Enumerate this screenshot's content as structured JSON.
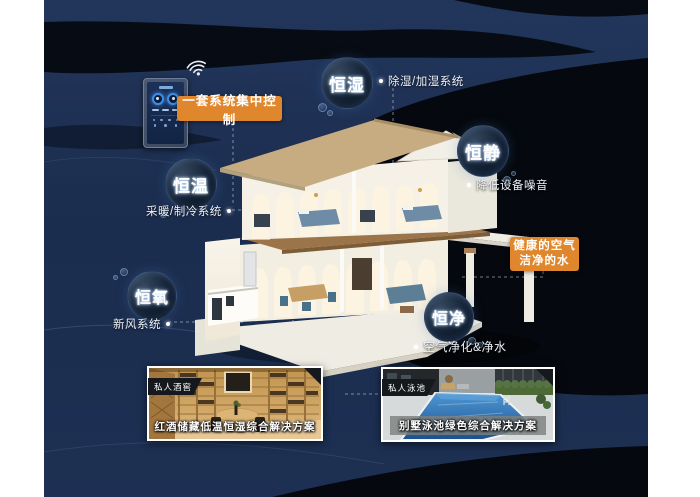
{
  "canvas": {
    "background_navy": "#1c2e4f",
    "background_dark": "#06090f",
    "accent_orange": "#e0862c"
  },
  "control_panel": {
    "wifi_icon": "wifi",
    "dial_accent": "#3b8de6"
  },
  "callouts": {
    "central_control": {
      "label": "一套系统集中控制"
    },
    "healthy_air": {
      "line1": "健康的空气",
      "line2": "洁净的水"
    }
  },
  "bubbles": [
    {
      "label": "恒湿",
      "desc": "除湿/加湿系统"
    },
    {
      "label": "恒静",
      "desc": "降低设备噪音"
    },
    {
      "label": "恒温",
      "desc": "采暖/制冷系统"
    },
    {
      "label": "恒氧",
      "desc": "新风系统"
    },
    {
      "label": "恒净",
      "desc": "空气净化&净水"
    }
  ],
  "photos": [
    {
      "badge": "私人酒窖",
      "caption": "红酒储藏低温恒湿综合解决方案"
    },
    {
      "badge": "私人泳池",
      "caption": "别墅泳池绿色综合解决方案"
    }
  ]
}
